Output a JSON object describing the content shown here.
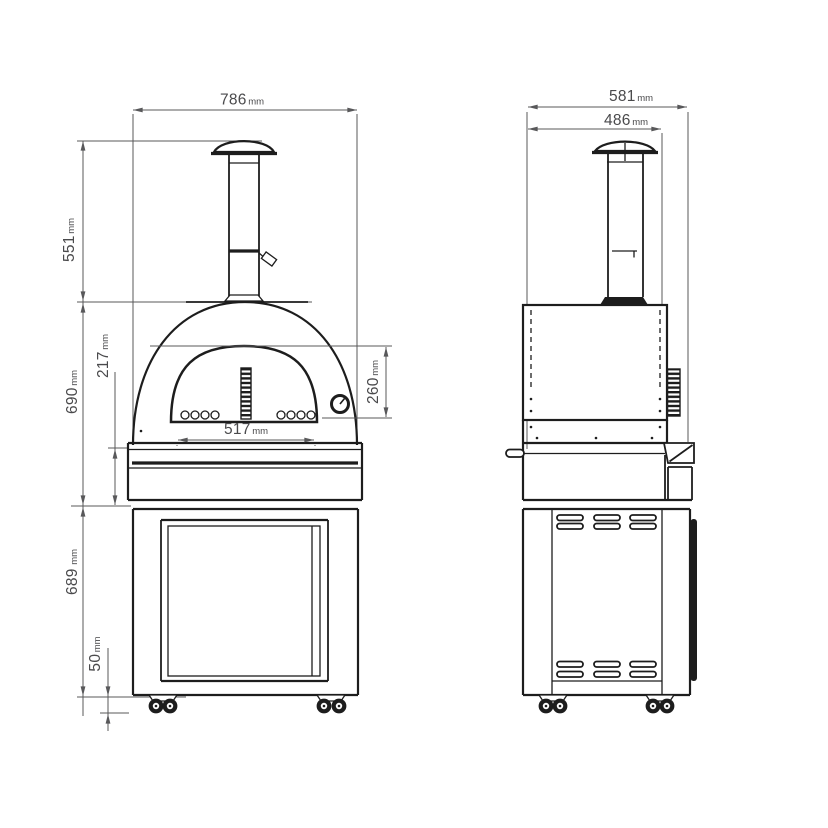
{
  "drawing": {
    "background_color": "#ffffff",
    "object_line_color": "#1d1d1d",
    "dimension_line_color": "#58585a",
    "text_color": "#4a4a4c",
    "unit": "mm",
    "front_view": {
      "dimensions": {
        "overall_width": {
          "value": "786",
          "unit": "mm"
        },
        "chimney_height": {
          "value": "551",
          "unit": "mm"
        },
        "oven_body_height": {
          "value": "690",
          "unit": "mm"
        },
        "worktop_height": {
          "value": "217",
          "unit": "mm"
        },
        "mouth_height": {
          "value": "260",
          "unit": "mm"
        },
        "mouth_width": {
          "value": "517",
          "unit": "mm"
        },
        "cabinet_height": {
          "value": "689",
          "unit": "mm"
        },
        "caster_clearance": {
          "value": "50",
          "unit": "mm"
        }
      }
    },
    "side_view": {
      "dimensions": {
        "overall_depth": {
          "value": "581",
          "unit": "mm"
        },
        "body_depth": {
          "value": "486",
          "unit": "mm"
        }
      }
    }
  }
}
